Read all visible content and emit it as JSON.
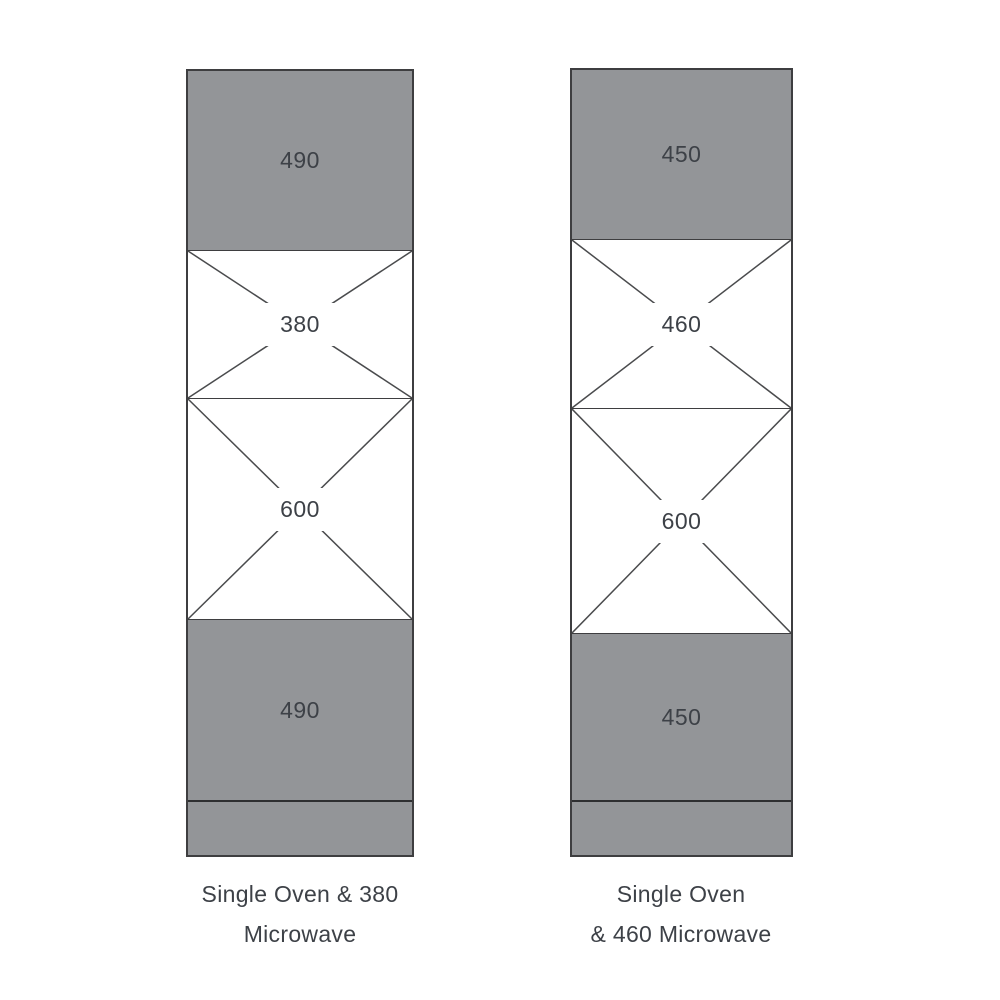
{
  "colors": {
    "panel_gray": "#939598",
    "outline": "#3e3e40",
    "separator": "#3e3e40",
    "plinth_line": "#2e2f31",
    "diagonal": "#4a4b4d",
    "text": "#3d4147",
    "background": "#ffffff"
  },
  "cabinets": [
    {
      "caption_line1": "Single Oven & 380",
      "caption_line2": "Microwave",
      "sections": [
        {
          "type": "panel",
          "label": "490"
        },
        {
          "type": "opening",
          "label": "380"
        },
        {
          "type": "opening",
          "label": "600"
        },
        {
          "type": "panel",
          "label": "490"
        },
        {
          "type": "plinth",
          "label": ""
        }
      ]
    },
    {
      "caption_line1": "Single Oven",
      "caption_line2": "& 460 Microwave",
      "sections": [
        {
          "type": "panel",
          "label": "450"
        },
        {
          "type": "opening",
          "label": "460"
        },
        {
          "type": "opening",
          "label": "600"
        },
        {
          "type": "panel",
          "label": "450"
        },
        {
          "type": "plinth",
          "label": ""
        }
      ]
    }
  ]
}
